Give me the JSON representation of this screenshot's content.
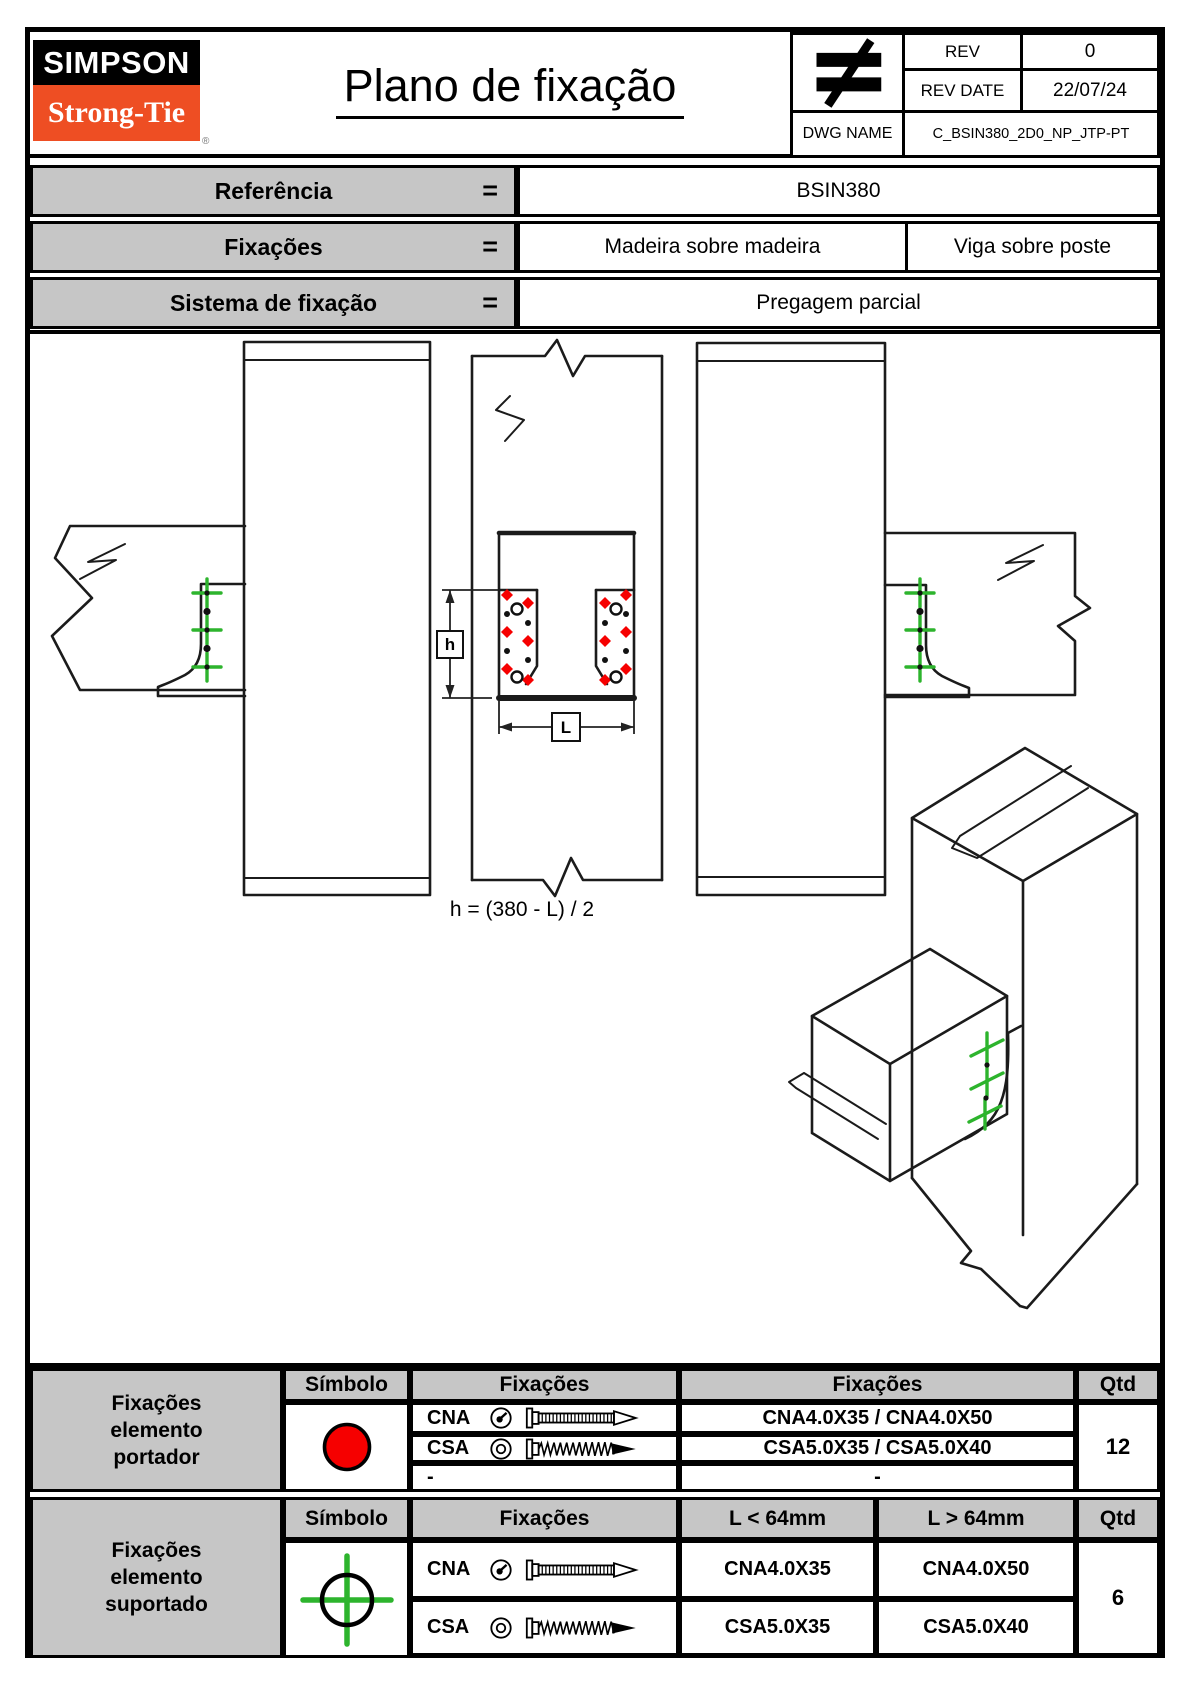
{
  "colors": {
    "accent_orange": "#ee4e23",
    "symbol_red": "#f60000",
    "symbol_green": "#2db42d",
    "cell_gray": "#c6c6c6"
  },
  "header": {
    "logo_top": "SIMPSON",
    "logo_bottom": "Strong-Tie",
    "registered_mark": "®",
    "title": "Plano de fixação",
    "title_block": {
      "rev_label": "REV",
      "rev_value": "0",
      "rev_date_label": "REV DATE",
      "rev_date_value": "22/07/24",
      "dwg_name_label": "DWG NAME",
      "dwg_name_value": "C_BSIN380_2D0_NP_JTP-PT"
    }
  },
  "reference_table": {
    "rows": [
      {
        "label": "Referência",
        "eq": "=",
        "values": [
          "BSIN380"
        ]
      },
      {
        "label": "Fixações",
        "eq": "=",
        "values": [
          "Madeira sobre madeira",
          "Viga sobre poste"
        ]
      },
      {
        "label": "Sistema de fixação",
        "eq": "=",
        "values": [
          "Pregagem parcial"
        ]
      }
    ]
  },
  "drawing": {
    "dim_h": "h",
    "dim_l": "L",
    "formula": "h = (380 - L) / 2"
  },
  "fixings_tables": {
    "portador": {
      "label_lines": [
        "Fixações",
        "elemento",
        "portador"
      ],
      "headers": [
        "Símbolo",
        "Fixações",
        "Fixações",
        "Qtd"
      ],
      "rows": [
        {
          "code": "CNA",
          "value": "CNA4.0X35 / CNA4.0X50"
        },
        {
          "code": "CSA",
          "value": "CSA5.0X35 / CSA5.0X40"
        },
        {
          "code": "-",
          "value": "-"
        }
      ],
      "qty": "12"
    },
    "suportado": {
      "label_lines": [
        "Fixações",
        "elemento",
        "suportado"
      ],
      "headers": [
        "Símbolo",
        "Fixações",
        "L < 64mm",
        "L > 64mm",
        "Qtd"
      ],
      "rows": [
        {
          "code": "CNA",
          "short": "CNA4.0X35",
          "long": "CNA4.0X50"
        },
        {
          "code": "CSA",
          "short": "CSA5.0X35",
          "long": "CSA5.0X40"
        }
      ],
      "qty": "6"
    }
  }
}
